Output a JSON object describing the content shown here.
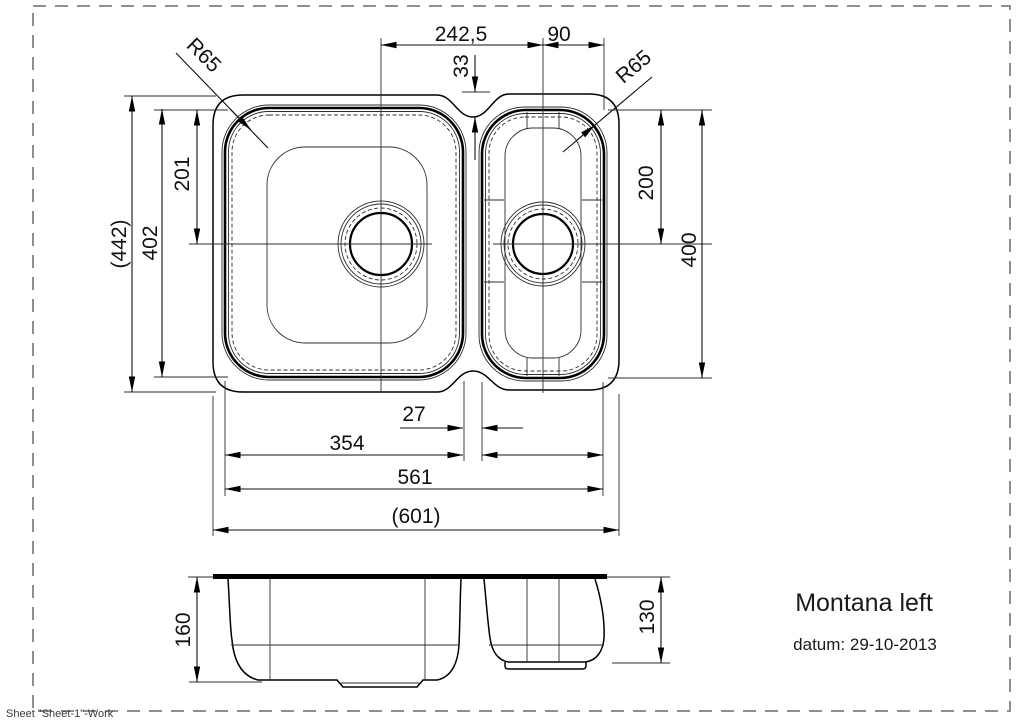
{
  "sheet": {
    "label": "Sheet \"Sheet-1\"-Work",
    "border_color": "#8f8f8f"
  },
  "title_block": {
    "product_name": "Montana left",
    "date": "datum: 29-10-2013"
  },
  "colors": {
    "line": "#000000",
    "thin_line": "#2e2e2e",
    "text": "#111111",
    "border": "#8f8f8f"
  },
  "plan_dimensions": {
    "drain_spacing": "242,5",
    "right_drain_to_edge": "90",
    "waist_offset": "33",
    "left_corner_radius": "R65",
    "right_corner_radius": "R65",
    "overall_depth": "(442)",
    "left_bowl_depth": "402",
    "left_drain_offset": "201",
    "right_drain_offset": "200",
    "right_bowl_depth": "400",
    "bowl_gap": "27",
    "left_bowl_width": "354",
    "bowls_width": "561",
    "overall_width": "(601)"
  },
  "section_dimensions": {
    "left_bowl_height": "160",
    "right_bowl_height": "130"
  }
}
